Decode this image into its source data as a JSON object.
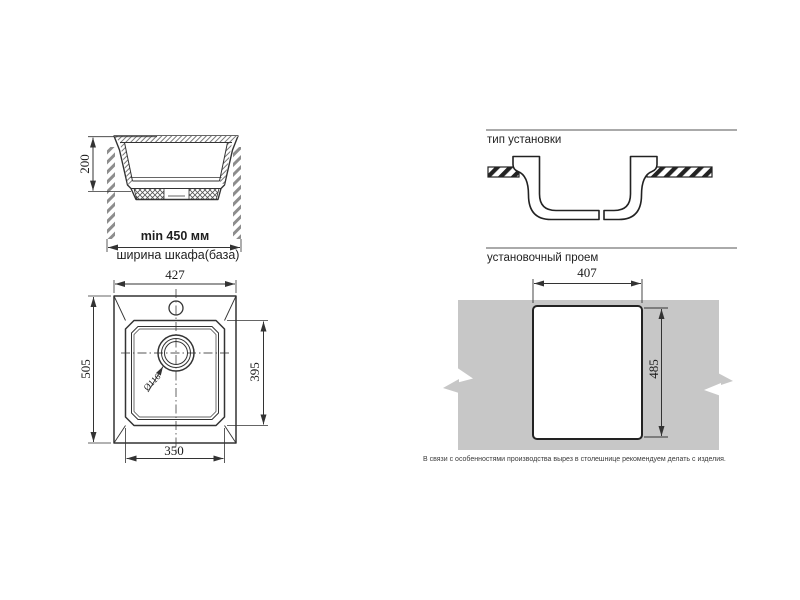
{
  "drawing": {
    "section_view": {
      "depth": "200",
      "min_width": "min 450 мм",
      "cabinet_width": "ширина шкафа(база)"
    },
    "top_view": {
      "overall_width": "427",
      "overall_length": "505",
      "bowl_length": "395",
      "bowl_width": "350",
      "drain_diameter": "Ø116"
    },
    "installation_type": {
      "title": "тип установки"
    },
    "installation_opening": {
      "title": "установочный проем",
      "cutout_width": "407",
      "cutout_height": "485",
      "note": "В связи с особенностями производства вырез в столешнице рекомендуем делать с изделия."
    }
  },
  "colors": {
    "line": "#333333",
    "profile_line": "#222222",
    "hatch_gray": "#8d8d8d",
    "countertop_gray": "#c7c7c7",
    "text": "#1a1a1a"
  }
}
